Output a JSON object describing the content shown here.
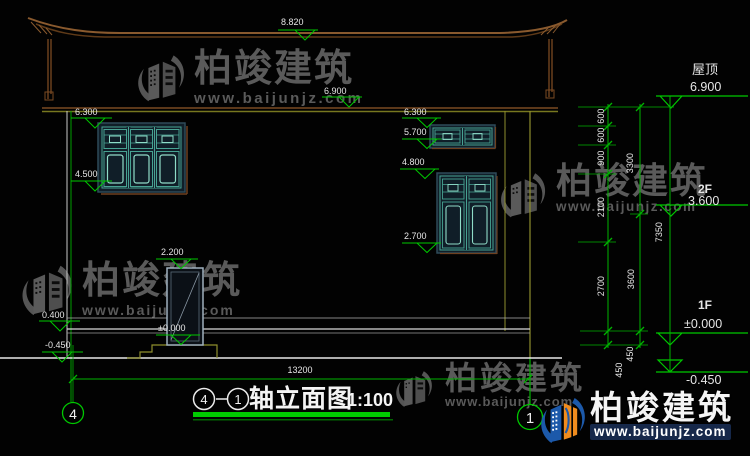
{
  "watermark": {
    "brand": "柏竣建筑",
    "url": "www.baijunjz.com"
  },
  "levels": {
    "ridge": "8.820",
    "eave": "6.900",
    "v6300": "6.300",
    "v5700": "5.700",
    "v4800": "4.800",
    "v4500": "4.500",
    "v2700": "2.700",
    "v2200": "2.200",
    "zero": "±0.000",
    "v0400": "0.400",
    "vneg": "-0.450"
  },
  "right_panel": {
    "roof_label": "屋顶",
    "roof_value": "6.900",
    "f2_label": "2F",
    "f2_value": "3.600",
    "f1_label": "1F",
    "f1_value": "±0.000",
    "ground_value": "-0.450"
  },
  "dims": {
    "d600": "600",
    "d900": "900",
    "d2100": "2100",
    "d2700": "2700",
    "d450": "450",
    "d3300": "3300",
    "d3600": "3600",
    "d7350": "7350",
    "width": "13200"
  },
  "axes": {
    "left": "4",
    "right": "1"
  },
  "title": {
    "bubble_left": "4",
    "bubble_right": "1",
    "text": "轴立面图",
    "scale": "1:100"
  }
}
